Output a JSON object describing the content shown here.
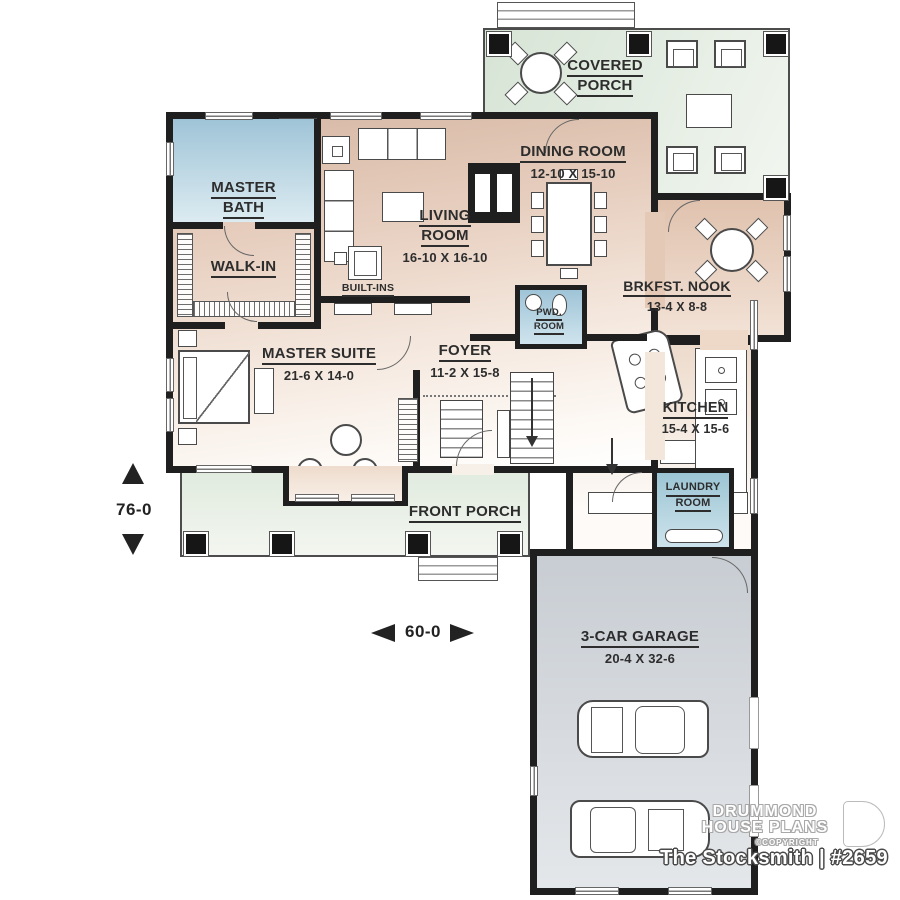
{
  "plan": {
    "brand": {
      "line1": "DRUMMOND",
      "line2": "HOUSE PLANS",
      "copyright": "©COPYRIGHT",
      "title": "The Stocksmith | #2659"
    },
    "overall": {
      "depth": "76-0",
      "width": "60-0"
    },
    "rooms": {
      "covered_porch": {
        "l1": "COVERED",
        "l2": "PORCH"
      },
      "dining": {
        "name": "DINING ROOM",
        "size": "12-10 X 15-10"
      },
      "master_bath": {
        "l1": "MASTER",
        "l2": "BATH"
      },
      "living": {
        "l1": "LIVING",
        "l2": "ROOM",
        "size": "16-10 X 16-10"
      },
      "walk_in": {
        "name": "WALK-IN"
      },
      "built_ins": {
        "name": "BUILT-INS"
      },
      "brkfst": {
        "name": "BRKFST. NOOK",
        "size": "13-4 X 8-8"
      },
      "pwd": {
        "l1": "PWD.",
        "l2": "ROOM"
      },
      "master_suite": {
        "name": "MASTER SUITE",
        "size": "21-6 X 14-0"
      },
      "foyer": {
        "name": "FOYER",
        "size": "11-2 X 15-8"
      },
      "kitchen": {
        "name": "KITCHEN",
        "size": "15-4 X 15-6"
      },
      "laundry": {
        "l1": "LAUNDRY",
        "l2": "ROOM"
      },
      "front_porch": {
        "name": "FRONT PORCH"
      },
      "garage": {
        "name": "3-CAR GARAGE",
        "size": "20-4 X 32-6"
      }
    },
    "colors": {
      "wall": "#1f1f1f",
      "floor_tan": "#e2c7b5",
      "bath_blue": "#9fc4d7",
      "porch_green": "#dde9dc",
      "garage_gray": "#ccd1d6",
      "label": "#2d2d2d"
    }
  }
}
